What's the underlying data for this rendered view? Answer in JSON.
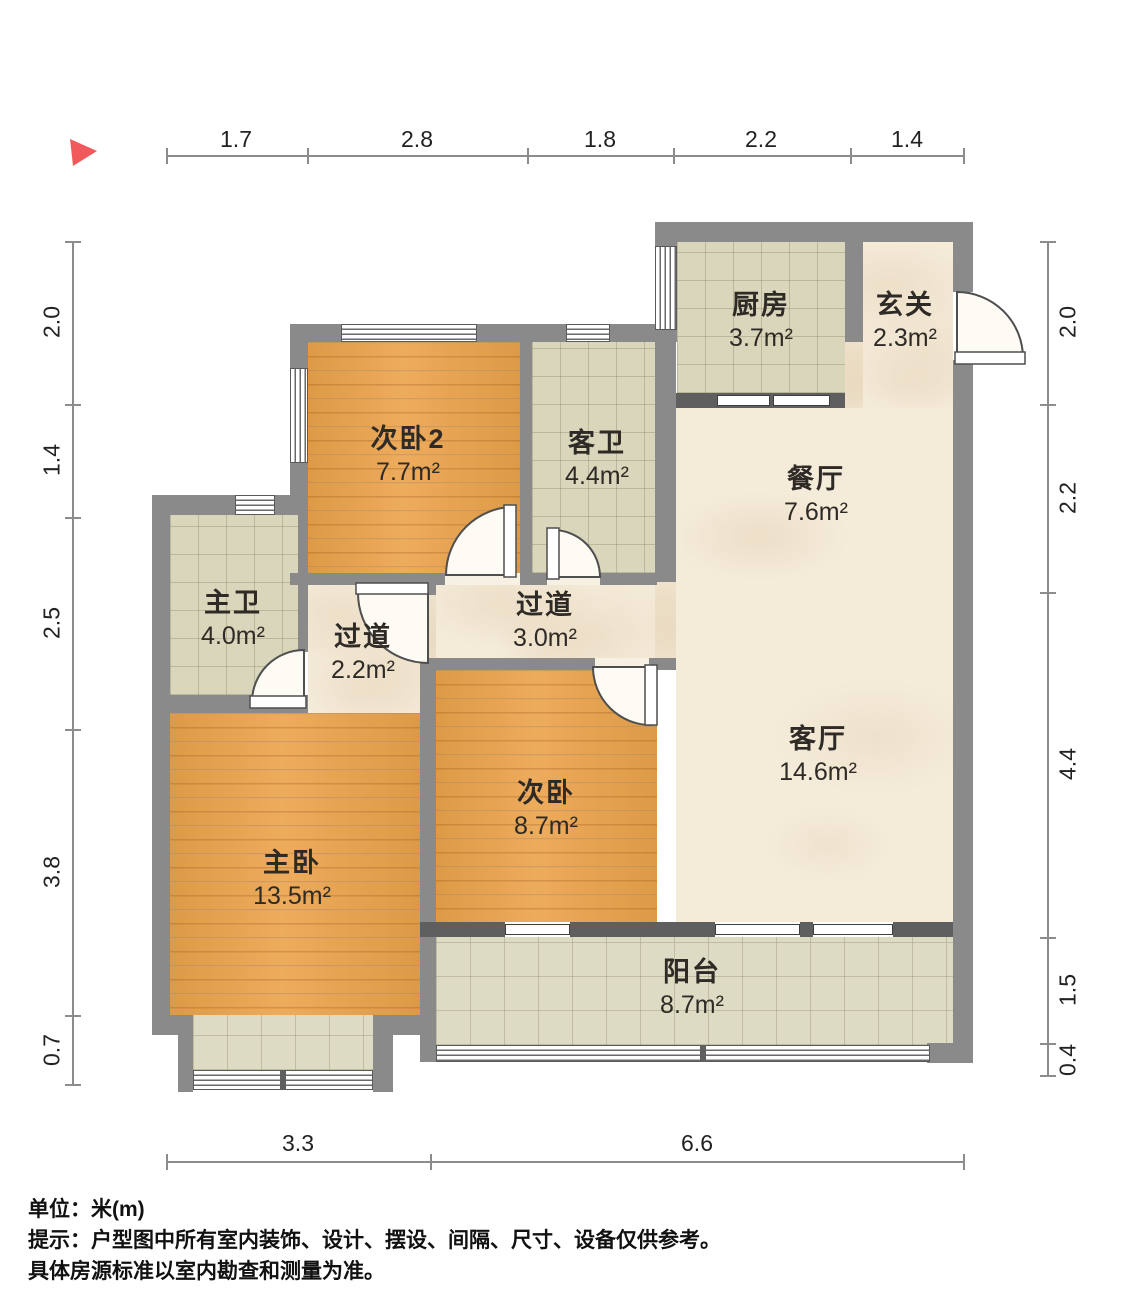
{
  "meta": {
    "type": "floor-plan",
    "unit_system": "meters"
  },
  "colors": {
    "wall": "#8a8a8a",
    "wall_dark": "#5f5f5f",
    "wood_floor": "#e3a14f",
    "tile_floor": "#d9d6bc",
    "marble_floor": "#f4ebd9",
    "north_arrow": "#f2595c",
    "text": "#2e2b26"
  },
  "north_indicator": {
    "name": "north-arrow"
  },
  "dimensions": {
    "top": [
      "1.7",
      "2.8",
      "1.8",
      "2.2",
      "1.4"
    ],
    "left": [
      "2.0",
      "1.4",
      "2.5",
      "3.8",
      "0.7"
    ],
    "right": [
      "2.0",
      "2.2",
      "4.4",
      "1.5",
      "0.4"
    ],
    "bottom": [
      "3.3",
      "6.6"
    ]
  },
  "rooms": [
    {
      "name": "厨房",
      "area": "3.7m²"
    },
    {
      "name": "玄关",
      "area": "2.3m²"
    },
    {
      "name": "餐厅",
      "area": "7.6m²"
    },
    {
      "name": "次卧2",
      "area": "7.7m²"
    },
    {
      "name": "客卫",
      "area": "4.4m²"
    },
    {
      "name": "主卫",
      "area": "4.0m²"
    },
    {
      "name": "过道",
      "area": "2.2m²"
    },
    {
      "name": "过道",
      "area": "3.0m²"
    },
    {
      "name": "客厅",
      "area": "14.6m²"
    },
    {
      "name": "次卧",
      "area": "8.7m²"
    },
    {
      "name": "主卧",
      "area": "13.5m²"
    },
    {
      "name": "阳台",
      "area": "8.7m²"
    }
  ],
  "footer": {
    "unit_line": "单位：米(m)",
    "tip_line1": "提示：户型图中所有室内装饰、设计、摆设、间隔、尺寸、设备仅供参考。",
    "tip_line2": "具体房源标准以室内勘查和测量为准。"
  }
}
